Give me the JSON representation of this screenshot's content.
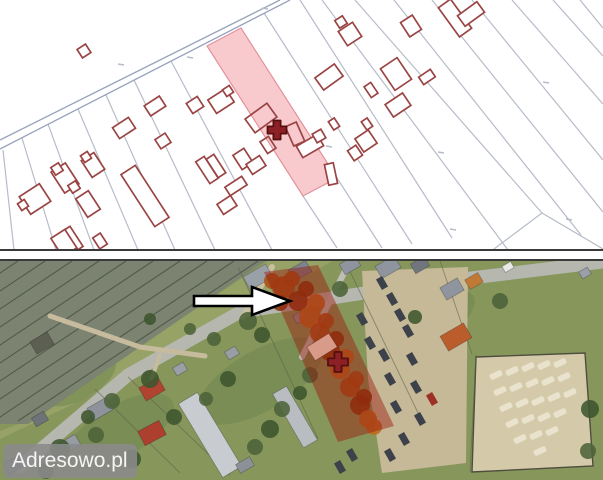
{
  "watermark": {
    "text": "Adresowo.pl"
  },
  "colors": {
    "map_background": "#ffffff",
    "parcel_line": "#b6bcc8",
    "road_line": "#98a2bd",
    "building_outline": "#9a4444",
    "building_fill": "#ffffff",
    "highlight_fill": "#f8c9cd",
    "highlight_outline": "#e2929b",
    "marker": "#8c2025",
    "marker_outline": "#53100f",
    "divider": "#3a3a3a",
    "grass": "#87975c",
    "railway_bed": "#7c8370",
    "railway_track": "#4a5244",
    "field": "#97a266",
    "garden_patch": "#6e844b",
    "fence": "#5a6148",
    "tree": "#4c6339",
    "tree_dark": "#3d552f",
    "vehicle": "#3c414a",
    "lot_blob": "#eae4cf",
    "aerial_overlay": "rgba(153,24,10,0.45)",
    "arrow_fill": "#ffffff",
    "arrow_outline": "#000000",
    "watermark_bg": "rgba(138,138,138,0.88)",
    "watermark_text": "#f5f5f5",
    "autumn_palette": [
      "#a85418",
      "#8a3c10",
      "#bf6a1f"
    ]
  },
  "cadastral_map": {
    "road_lines": [
      [
        0,
        140,
        280,
        0
      ],
      [
        0,
        149,
        290,
        0
      ]
    ],
    "parcel_lines": [
      [
        3,
        150,
        14,
        250
      ],
      [
        22,
        138,
        56,
        250
      ],
      [
        48,
        124,
        94,
        250
      ],
      [
        78,
        109,
        138,
        250
      ],
      [
        106,
        95,
        175,
        250
      ],
      [
        134,
        80,
        215,
        250
      ],
      [
        171,
        61,
        272,
        250
      ],
      [
        303,
        196,
        337,
        248
      ],
      [
        337,
        178,
        382,
        248
      ],
      [
        264,
        13,
        412,
        244
      ],
      [
        300,
        0,
        452,
        238
      ],
      [
        322,
        0,
        508,
        250
      ],
      [
        355,
        0,
        542,
        213
      ],
      [
        542,
        213,
        494,
        249
      ],
      [
        542,
        213,
        603,
        249
      ],
      [
        394,
        0,
        581,
        235
      ],
      [
        432,
        0,
        603,
        212
      ],
      [
        472,
        0,
        603,
        160
      ],
      [
        512,
        0,
        603,
        104
      ],
      [
        553,
        0,
        603,
        56
      ],
      [
        580,
        0,
        603,
        28
      ]
    ],
    "tick_marks": [
      [
        118,
        64
      ],
      [
        187,
        57
      ],
      [
        262,
        8
      ],
      [
        326,
        146
      ],
      [
        450,
        229
      ],
      [
        566,
        219
      ],
      [
        543,
        82
      ],
      [
        438,
        152
      ]
    ],
    "highlight_parcel": {
      "points": "207,46 241,28 337,178 303,196"
    },
    "buildings": [
      [
        84,
        51,
        10,
        10,
        -33,
        0
      ],
      [
        124,
        128,
        19,
        13,
        -33,
        0
      ],
      [
        155,
        106,
        18,
        12,
        -33,
        0
      ],
      [
        163,
        141,
        12,
        11,
        -33,
        0
      ],
      [
        195,
        105,
        13,
        12,
        -33,
        0
      ],
      [
        221,
        101,
        21,
        16,
        -33,
        0
      ],
      [
        228,
        91,
        8,
        8,
        -33,
        0
      ],
      [
        261,
        118,
        27,
        17,
        -36,
        1
      ],
      [
        295,
        134,
        12,
        21,
        -24,
        1
      ],
      [
        268,
        145,
        10,
        14,
        -33,
        1
      ],
      [
        310,
        146,
        24,
        13,
        -30,
        0
      ],
      [
        319,
        136,
        10,
        10,
        -30,
        0
      ],
      [
        331,
        174,
        9,
        21,
        -12,
        0
      ],
      [
        334,
        124,
        7,
        10,
        -33,
        0
      ],
      [
        329,
        77,
        24,
        15,
        -36,
        0
      ],
      [
        350,
        34,
        17,
        17,
        -33,
        0
      ],
      [
        341,
        22,
        9,
        9,
        -33,
        0
      ],
      [
        411,
        26,
        14,
        17,
        -33,
        0
      ],
      [
        455,
        18,
        15,
        36,
        -36,
        0
      ],
      [
        471,
        14,
        24,
        13,
        -36,
        0
      ],
      [
        396,
        74,
        20,
        26,
        -34,
        0
      ],
      [
        427,
        77,
        14,
        9,
        -34,
        0
      ],
      [
        371,
        90,
        8,
        13,
        -34,
        0
      ],
      [
        398,
        105,
        21,
        15,
        -34,
        0
      ],
      [
        366,
        141,
        16,
        16,
        -34,
        0
      ],
      [
        355,
        153,
        10,
        12,
        -34,
        0
      ],
      [
        367,
        124,
        7,
        10,
        -34,
        0
      ],
      [
        35,
        199,
        24,
        21,
        -33,
        0
      ],
      [
        23,
        205,
        8,
        8,
        -33,
        0
      ],
      [
        65,
        178,
        17,
        25,
        -33,
        0
      ],
      [
        57,
        169,
        9,
        9,
        -33,
        0
      ],
      [
        74,
        187,
        9,
        9,
        -33,
        0
      ],
      [
        93,
        165,
        15,
        20,
        -33,
        0
      ],
      [
        86,
        157,
        8,
        8,
        -33,
        0
      ],
      [
        88,
        204,
        15,
        22,
        -33,
        0
      ],
      [
        145,
        196,
        17,
        62,
        -33,
        0
      ],
      [
        207,
        170,
        10,
        26,
        -33,
        0
      ],
      [
        216,
        166,
        9,
        22,
        -33,
        0
      ],
      [
        243,
        159,
        13,
        17,
        -33,
        0
      ],
      [
        256,
        165,
        16,
        12,
        -33,
        0
      ],
      [
        236,
        186,
        20,
        10,
        -33,
        0
      ],
      [
        227,
        205,
        16,
        12,
        -33,
        0
      ],
      [
        64,
        243,
        17,
        22,
        -33,
        0
      ],
      [
        74,
        238,
        6,
        24,
        -33,
        0
      ],
      [
        100,
        241,
        9,
        13,
        -33,
        0
      ]
    ],
    "marker": {
      "x": 277,
      "y": 130
    }
  },
  "aerial_view": {
    "railway_area": "0,0 265,0 28,163 0,163",
    "railway_lines": [
      [
        18,
        0,
        -222,
        160
      ],
      [
        45,
        0,
        -195,
        160
      ],
      [
        72,
        0,
        -168,
        160
      ],
      [
        99,
        0,
        -141,
        160
      ],
      [
        126,
        0,
        -114,
        160
      ],
      [
        153,
        0,
        -87,
        160
      ],
      [
        180,
        0,
        -60,
        160
      ],
      [
        207,
        0,
        -33,
        160
      ],
      [
        234,
        0,
        -6,
        160
      ],
      [
        258,
        0,
        18,
        160
      ]
    ],
    "field_area": "268,0 332,0 243,53 130,116 0,178 0,170 40,155 99,114 158,73 218,33",
    "grass_patches": [
      [
        120,
        170,
        60,
        26
      ],
      [
        260,
        120,
        70,
        30
      ],
      [
        430,
        60,
        50,
        22
      ],
      [
        520,
        170,
        40,
        18
      ],
      [
        80,
        120,
        40,
        18
      ]
    ],
    "roads": [
      {
        "pts": "603,1 430,22 240,51 128,114 20,206",
        "w": 13,
        "c": "#b6b7af"
      },
      {
        "pts": "243,56 272,6",
        "w": 6,
        "c": "#cabfa0"
      },
      {
        "pts": "348,4 302,96",
        "w": 6,
        "c": "#bdbeb6"
      },
      {
        "pts": "50,55 140,86 205,95",
        "w": 5,
        "c": "#c6bb9d"
      },
      {
        "pts": "160,94 148,128",
        "w": 4,
        "c": "#c6bb9d"
      }
    ],
    "dirt_areas": [
      {
        "pts": "362,10 468,6 466,202 382,212 368,118",
        "c": "#c6b997"
      },
      {
        "pts": "476,96 585,92 593,205 472,211",
        "c": "#d4c9a9",
        "stroke": "#4e4e3e"
      }
    ],
    "fences": [
      [
        238,
        6,
        318,
        178
      ],
      [
        345,
        0,
        420,
        156
      ],
      [
        440,
        0,
        472,
        93
      ],
      [
        95,
        128,
        180,
        212
      ],
      [
        128,
        116,
        230,
        214
      ],
      [
        476,
        94,
        470,
        211
      ]
    ],
    "buildings": [
      [
        258,
        16,
        26,
        15,
        -30,
        "#9aa0a8"
      ],
      [
        300,
        10,
        20,
        13,
        -30,
        "#7d838c"
      ],
      [
        388,
        6,
        22,
        14,
        -30,
        "#8f959e"
      ],
      [
        420,
        4,
        16,
        11,
        -30,
        "#71767e"
      ],
      [
        452,
        28,
        20,
        14,
        -30,
        "#8f959e"
      ],
      [
        474,
        20,
        15,
        11,
        -30,
        "#c07a35"
      ],
      [
        456,
        76,
        27,
        17,
        -30,
        "#bb5c2c"
      ],
      [
        300,
        56,
        12,
        9,
        -30,
        "#9196a0"
      ],
      [
        152,
        128,
        22,
        15,
        -30,
        "#b14331"
      ],
      [
        152,
        172,
        24,
        16,
        -28,
        "#ad3f2e"
      ],
      [
        100,
        148,
        22,
        14,
        -30,
        "#8d929b"
      ],
      [
        70,
        183,
        18,
        12,
        -30,
        "#979ca4"
      ],
      [
        40,
        158,
        14,
        10,
        -30,
        "#6e7378"
      ],
      [
        210,
        174,
        22,
        86,
        -31,
        "#c8cbcf"
      ],
      [
        295,
        156,
        16,
        62,
        -30,
        "#b9bdc2"
      ],
      [
        245,
        204,
        16,
        10,
        -30,
        "#8c9198"
      ],
      [
        14,
        204,
        18,
        12,
        -30,
        "#7f848c"
      ],
      [
        350,
        4,
        18,
        12,
        -30,
        "#8f959e"
      ],
      [
        508,
        6,
        10,
        7,
        -30,
        "#e8e8e4"
      ],
      [
        585,
        12,
        10,
        8,
        -30,
        "#9aa0a8"
      ],
      [
        42,
        82,
        20,
        14,
        -30,
        "#5c5f52"
      ],
      [
        232,
        92,
        12,
        9,
        -30,
        "#999ea6"
      ],
      [
        180,
        108,
        12,
        9,
        -30,
        "#9aa0a8"
      ]
    ],
    "vehicles": [
      [
        382,
        22
      ],
      [
        392,
        38
      ],
      [
        400,
        54
      ],
      [
        408,
        70
      ],
      [
        384,
        94
      ],
      [
        412,
        98
      ],
      [
        390,
        118
      ],
      [
        416,
        126
      ],
      [
        396,
        146
      ],
      [
        420,
        158
      ],
      [
        404,
        178
      ],
      [
        390,
        194
      ],
      [
        352,
        194
      ],
      [
        340,
        206
      ],
      [
        432,
        138,
        "#9e3126"
      ],
      [
        362,
        58
      ],
      [
        370,
        82
      ]
    ],
    "lot_blobs": [
      [
        496,
        114
      ],
      [
        512,
        110
      ],
      [
        528,
        106
      ],
      [
        544,
        104
      ],
      [
        560,
        102
      ],
      [
        500,
        130
      ],
      [
        516,
        126
      ],
      [
        532,
        122
      ],
      [
        548,
        120
      ],
      [
        564,
        116
      ],
      [
        506,
        146
      ],
      [
        522,
        142
      ],
      [
        538,
        140
      ],
      [
        554,
        136
      ],
      [
        570,
        132
      ],
      [
        512,
        162
      ],
      [
        528,
        158
      ],
      [
        544,
        156
      ],
      [
        560,
        152
      ],
      [
        520,
        178
      ],
      [
        536,
        174
      ],
      [
        552,
        170
      ],
      [
        540,
        190
      ]
    ],
    "trees_green": [
      [
        248,
        60,
        9
      ],
      [
        262,
        74,
        8
      ],
      [
        214,
        78,
        7
      ],
      [
        150,
        118,
        9
      ],
      [
        112,
        140,
        8
      ],
      [
        88,
        156,
        7
      ],
      [
        340,
        28,
        8
      ],
      [
        415,
        56,
        7
      ],
      [
        500,
        40,
        8
      ],
      [
        590,
        148,
        9
      ],
      [
        588,
        190,
        8
      ],
      [
        60,
        188,
        10
      ],
      [
        96,
        174,
        8
      ],
      [
        132,
        198,
        9
      ],
      [
        46,
        210,
        8
      ],
      [
        174,
        156,
        8
      ],
      [
        206,
        138,
        7
      ],
      [
        228,
        118,
        8
      ],
      [
        310,
        114,
        8
      ],
      [
        300,
        132,
        7
      ],
      [
        282,
        148,
        8
      ],
      [
        270,
        168,
        9
      ],
      [
        255,
        186,
        8
      ],
      [
        150,
        58,
        6
      ],
      [
        190,
        68,
        6
      ]
    ],
    "trees_autumn": [
      [
        284,
        26,
        11
      ],
      [
        298,
        40,
        10
      ],
      [
        310,
        56,
        11
      ],
      [
        320,
        72,
        10
      ],
      [
        330,
        90,
        10
      ],
      [
        340,
        108,
        10
      ],
      [
        350,
        126,
        10
      ],
      [
        360,
        144,
        10
      ],
      [
        368,
        158,
        9
      ],
      [
        292,
        18,
        8
      ],
      [
        306,
        28,
        8
      ],
      [
        316,
        42,
        9
      ],
      [
        326,
        60,
        8
      ],
      [
        336,
        78,
        8
      ],
      [
        346,
        96,
        8
      ],
      [
        356,
        118,
        8
      ],
      [
        364,
        136,
        8
      ],
      [
        374,
        166,
        8
      ],
      [
        272,
        20,
        8
      ],
      [
        280,
        42,
        8
      ]
    ],
    "highlight_parcel": {
      "points": "264,11 318,4 394,165 338,181"
    },
    "pink_house": {
      "cx": 322,
      "cy": 86,
      "w": 26,
      "h": 16,
      "r": -32,
      "c": "#d89b89"
    },
    "marker": {
      "x": 338,
      "y": 101
    },
    "arrow": {
      "points": "194,35 252,35 252,26 290,40 252,54 252,45 194,45"
    }
  }
}
